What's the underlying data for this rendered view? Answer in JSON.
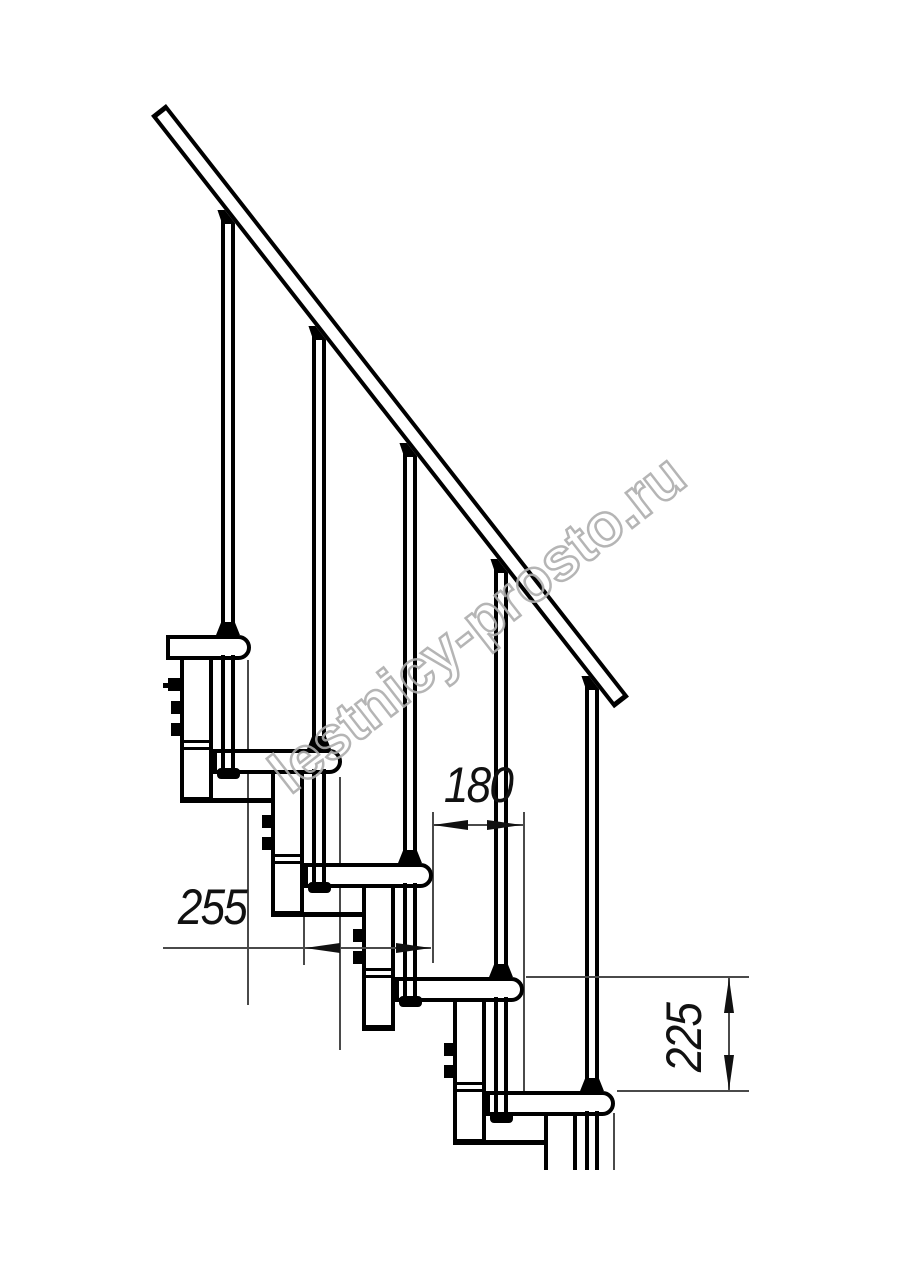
{
  "drawing": {
    "type": "modular-staircase-side-view-technical-drawing",
    "watermark_text": "lestnicy-prosto.ru",
    "dimensions": {
      "tread_depth": {
        "value": "255",
        "orientation": "horizontal"
      },
      "step_run": {
        "value": "180",
        "orientation": "horizontal"
      },
      "step_rise": {
        "value": "225",
        "orientation": "vertical"
      }
    },
    "colors": {
      "line": "#000000",
      "background": "#ffffff",
      "dimension_line": "#4a4a4a",
      "watermark": "#adadad"
    }
  }
}
